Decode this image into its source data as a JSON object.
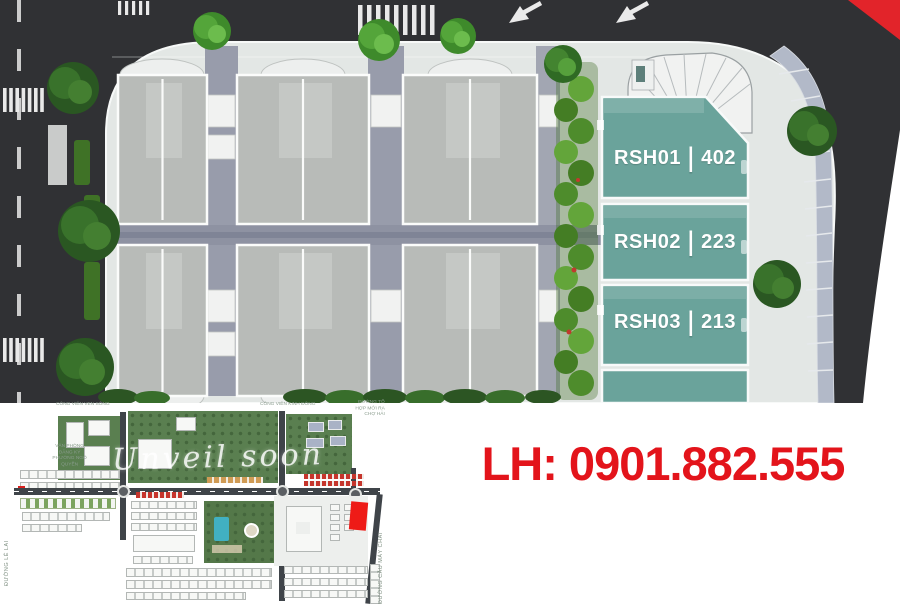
{
  "plan": {
    "blocks": [
      {
        "code": "RSH01",
        "separator": "|",
        "units": "402"
      },
      {
        "code": "RSH02",
        "separator": "|",
        "units": "223"
      },
      {
        "code": "RSH03",
        "separator": "|",
        "units": "213"
      }
    ]
  },
  "contact": {
    "text": "LH: 0901.882.555"
  },
  "minimap": {
    "watermark": "Unveil soon",
    "labels": {
      "park_top_left": "CÔNG VIÊN VEN SÔNG",
      "park_top_right": "CÔNG VIÊN KINH ĐÔNG",
      "note_top_right": "ĐƯỜNG TỔ HỢP MỚI RA CHỢ HẢI",
      "office_left": "VĂN PHÒNG ĐĂNG KÝ PHƯỜNG NGÔ QUYỀN",
      "road_left": "ĐƯỜNG LÊ LAI",
      "road_right": "ĐƯỜNG CẦU MÁY CHAI"
    }
  },
  "colors": {
    "accent_red": "#e3141b",
    "teal_block": "#6aa39b",
    "asphalt": "#303134",
    "plaza": "#e3e7e5",
    "hedge_green": "#4e8c2c",
    "corner_flag_red": "#e2242a"
  }
}
